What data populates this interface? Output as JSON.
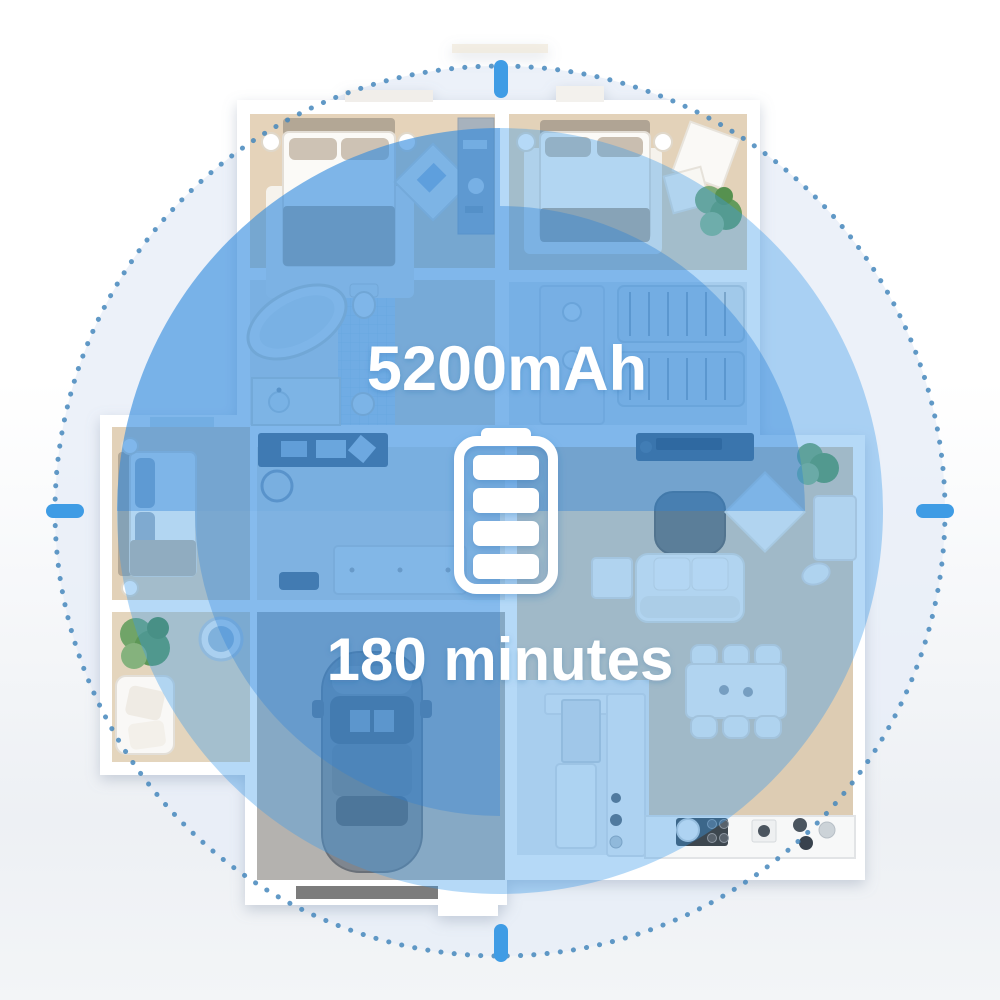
{
  "labels": {
    "capacity": "5200mAh",
    "runtime": "180 minutes"
  },
  "icons": {
    "center": "battery-full-icon",
    "battery_bars": 4
  },
  "colors": {
    "overlay_blue": "#3D9BEA",
    "sector_blue": "#2B82D8",
    "ring_dot_blue": "#4587BC",
    "tick_blue": "#3F9CE5",
    "text_white": "#FFFFFF",
    "floor_beige": "#E3D2B9",
    "garage_gray": "#B4B2AF"
  }
}
